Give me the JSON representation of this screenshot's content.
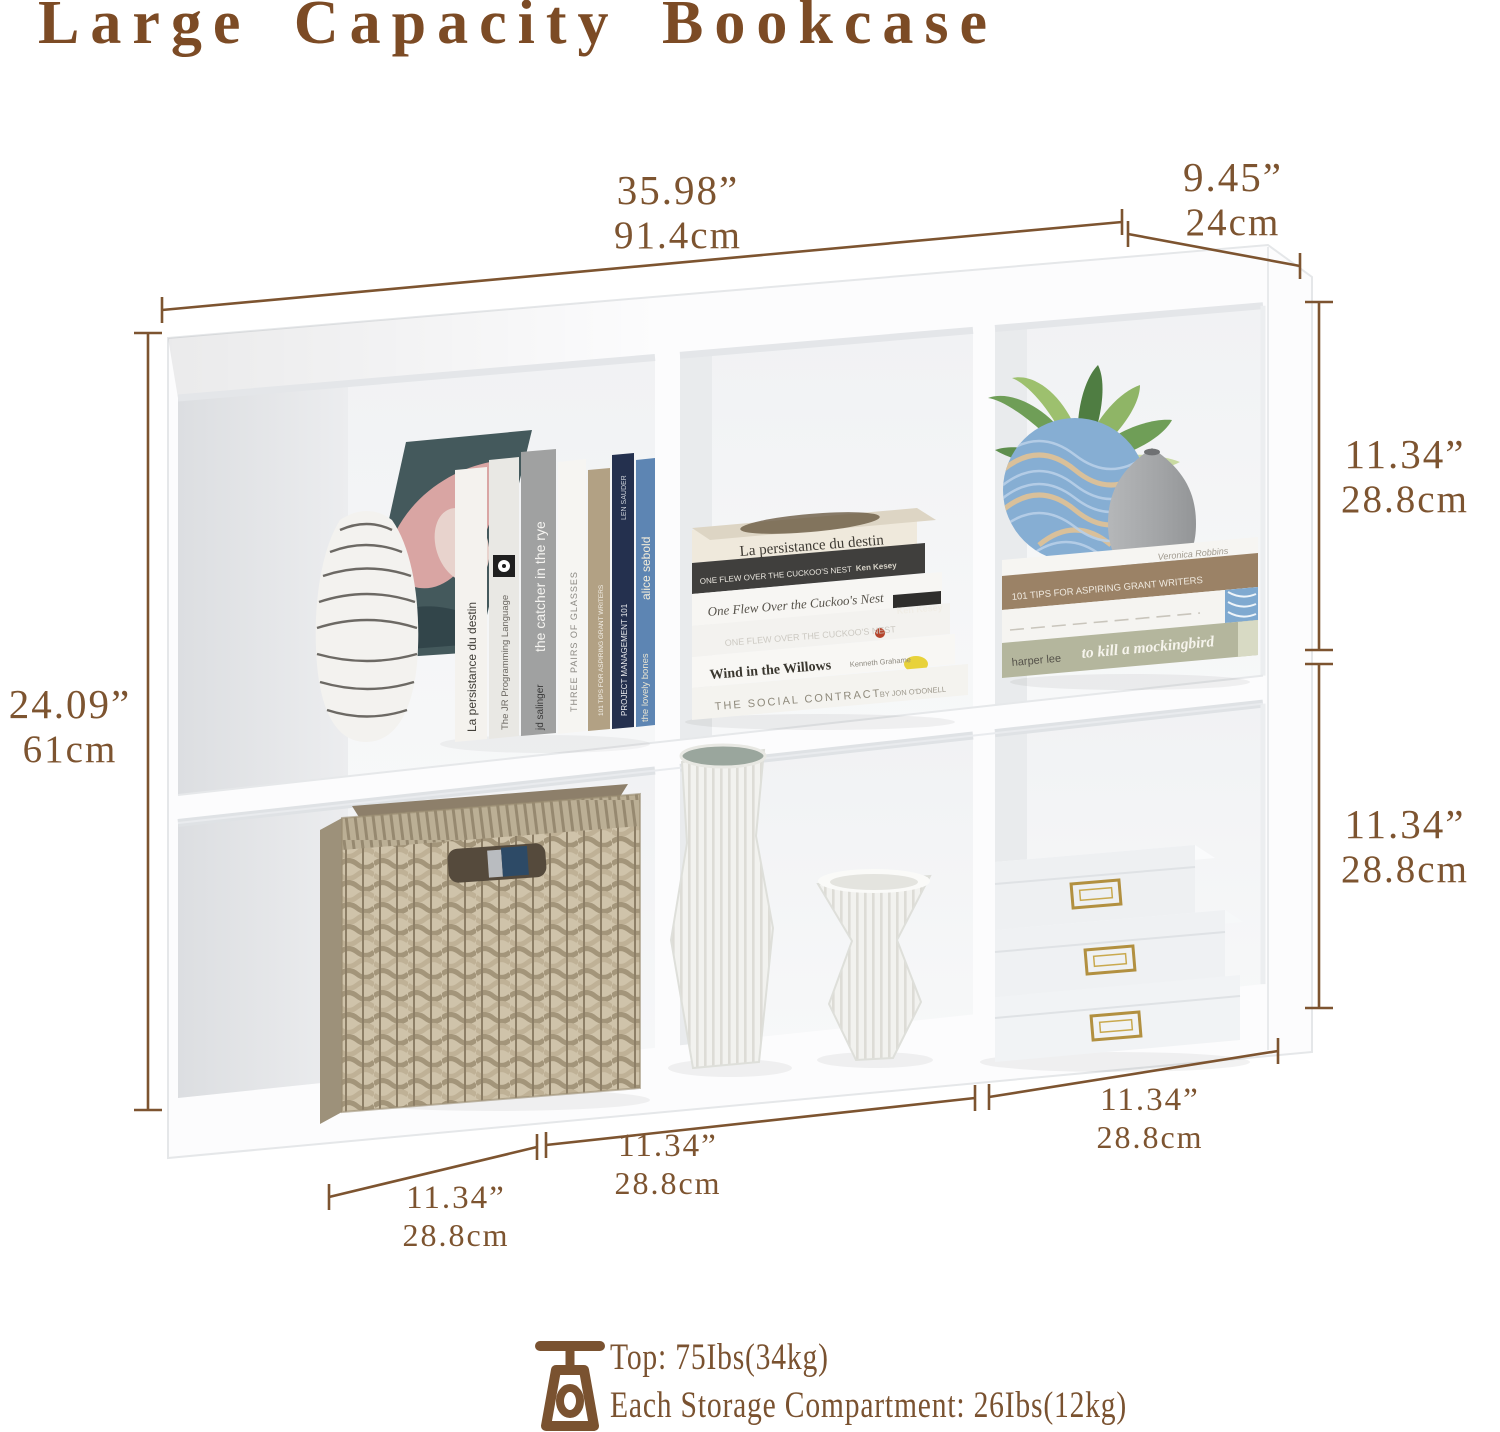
{
  "title": "Large Capacity Bookcase",
  "dims": {
    "width_in": "35.98”",
    "width_cm": "91.4cm",
    "depth_in": "9.45”",
    "depth_cm": "24cm",
    "height_in": "24.09”",
    "height_cm": "61cm",
    "comp_top_in": "11.34”",
    "comp_top_cm": "28.8cm",
    "comp_bottom_in": "11.34”",
    "comp_bottom_cm": "28.8cm",
    "comp_w_left_in": "11.34”",
    "comp_w_left_cm": "28.8cm",
    "comp_w_mid_in": "11.34”",
    "comp_w_mid_cm": "28.8cm",
    "comp_w_right_in": "11.34”",
    "comp_w_right_cm": "28.8cm"
  },
  "capacity": {
    "top": "Top: 75Ibs(34kg)",
    "each": "Each Storage Compartment: 26Ibs(12kg)"
  },
  "books": {
    "persistance": "La persistance du destin",
    "jr": "The JR Programming Language",
    "catcher": "the catcher in the rye",
    "salinger": "jd salinger",
    "glasses": "THREE PAIRS OF GLASSES",
    "grant": "101 TIPS FOR ASPIRING GRANT WRITERS",
    "pm": "PROJECT MANAGEMENT 101",
    "sauder": "LEN SAUDER",
    "lovely": "the lovely bones",
    "sebold": "alice sebold",
    "cuckoo_caps": "ONE FLEW OVER THE CUCKOO'S NEST",
    "kesey": "Ken Kesey",
    "cuckoo": "One Flew Over the Cuckoo's Nest",
    "willows": "Wind in the Willows",
    "grahame": "Kenneth Grahame",
    "social": "THE SOCIAL CONTRACT",
    "odonell": "BY JON O'DONELL",
    "veronica": "Veronica Robbins",
    "harper": "harper lee",
    "mockingbird": "to kill a mockingbird"
  },
  "colors": {
    "accent": "#7d5430",
    "title": "#7c4b25",
    "gold": "#b29040"
  }
}
